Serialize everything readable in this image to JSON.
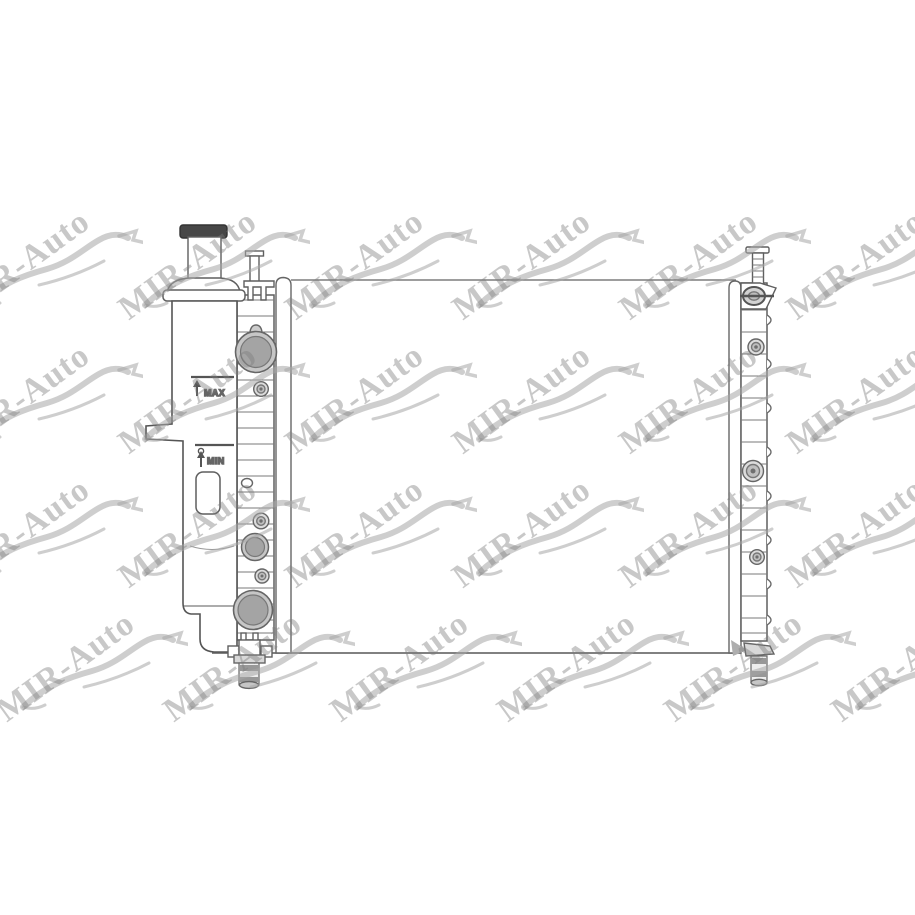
{
  "drawing": {
    "max_label": "MAX",
    "min_label": "MIN"
  },
  "watermark": {
    "text": "MIR-Auto",
    "cols": 6,
    "rows": 4,
    "origin_x": -37,
    "origin_y": 205,
    "step_x": 167,
    "step_y": 134,
    "row_offsets": [
      0,
      0,
      0,
      45
    ]
  },
  "colors": {
    "background": "#ffffff",
    "line": "#666666",
    "cap_fill": "#474747",
    "port_ring_fill": "#c6c6c6",
    "port_fill": "#a4a4a4",
    "bolt_fill": "#dcdcdc",
    "bolt_mid_fill": "#bfbfbf",
    "band_fill": "#989898",
    "collar_fill": "#d8d8d8",
    "eyelet_fill": "#d2d2d2",
    "watermark_text": "rgba(125,125,125,0.42)",
    "watermark_stroke": "rgba(165,165,165,0.55)"
  }
}
